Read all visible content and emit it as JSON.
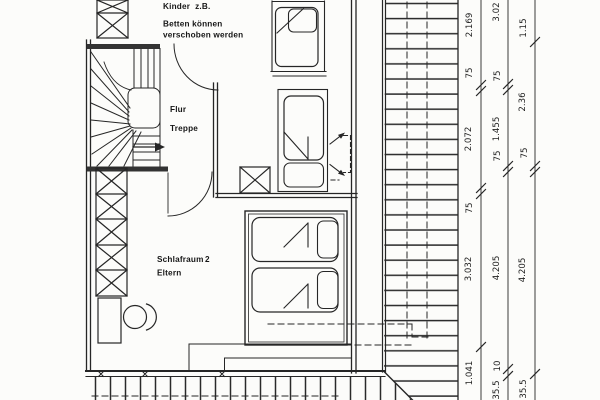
{
  "colors": {
    "ink": "#262626",
    "paper": "#fcfcfa"
  },
  "labels": {
    "room1_line1": "Kinder  z.B.",
    "room1_line2": "Betten können",
    "room1_line3": "verschoben werden",
    "hall": "Flur",
    "stairs": "Treppe",
    "room2_name": "Schlafraum",
    "room2_number": "2",
    "room2_occupants": "Eltern"
  },
  "dimensions": {
    "chain_inner": [
      "2.169",
      "75",
      "2.072",
      "75",
      "3.032",
      "1.041"
    ],
    "chain_middle": [
      "3.02",
      "75",
      "1.455",
      "75",
      "4.205",
      "10",
      "35.5"
    ],
    "chain_outer": [
      "1.15",
      "2.36",
      "75",
      "4.205",
      "35.5"
    ]
  }
}
